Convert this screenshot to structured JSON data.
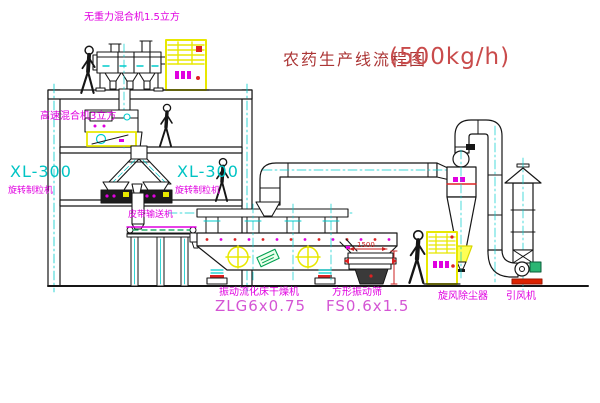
{
  "title": {
    "text": "农药生产线流程图",
    "capacity": "(500kg/h)"
  },
  "equipment_labels": {
    "top_mixer": "无重力混合机1.5立方",
    "second_floor_mixer": "高速混合机3立方",
    "granulator_left": {
      "model": "XL-300",
      "name": "旋转制粒机"
    },
    "granulator_mid": {
      "model": "XL-300",
      "name": "旋转制粒机"
    },
    "belt_conveyor": "皮带输送机",
    "fluid_bed_dryer": {
      "name": "振动流化床干燥机",
      "model": "ZLG6x0.75"
    },
    "vibrating_sieve": {
      "name": "方形振动筛",
      "model": "FS0.6x1.5"
    },
    "cyclone": "旋风除尘器",
    "fan": "引风机"
  },
  "dimensions": {
    "sieve_width": "1500"
  },
  "colors": {
    "label_magenta": "#e000e0",
    "model_cyan": "#00c4c4",
    "title_red": "#ab3535",
    "cabinet_yellow": "#e8e800",
    "line_black": "#161616",
    "accent_red": "#cc2222",
    "motor_green": "#2bb673"
  }
}
